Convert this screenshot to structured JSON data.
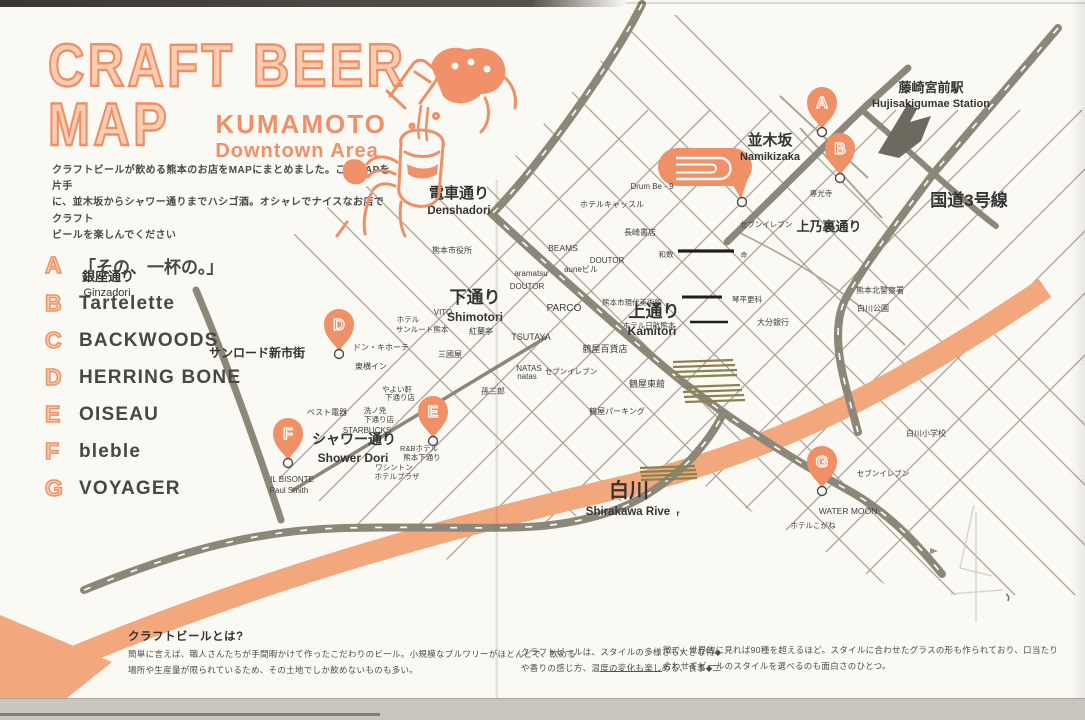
{
  "header": {
    "title_line1": "CRAFT BEER",
    "title_line2": "MAP",
    "subtitle_region": "KUMAMOTO",
    "subtitle_area": "Downtown Area",
    "intro_lines": [
      "クラフトビールが飲める熊本のお店をMAPにまとめました。このMAPを片手",
      "に、並木坂からシャワー通りまでハシゴ酒。オシャレでナイスなお店でクラフト",
      "ビールを楽しんでください"
    ]
  },
  "legend": {
    "items": [
      {
        "letter": "A",
        "name": "「その、一杯の。」"
      },
      {
        "letter": "B",
        "name": "Tartelette"
      },
      {
        "letter": "C",
        "name": "BACKWOODS"
      },
      {
        "letter": "D",
        "name": "HERRING BONE"
      },
      {
        "letter": "E",
        "name": "OISEAU"
      },
      {
        "letter": "F",
        "name": "bleble"
      },
      {
        "letter": "G",
        "name": "VOYAGER"
      }
    ]
  },
  "map": {
    "pins": [
      "A",
      "B",
      "C",
      "D",
      "E",
      "F",
      "G"
    ],
    "streets": {
      "denshadori": {
        "jp": "電車通り",
        "en": "Denshadori"
      },
      "ginzadori": {
        "jp": "銀座通り",
        "en": "Ginzadori"
      },
      "shimotori": {
        "jp": "下通り",
        "en": "Shimotori"
      },
      "kamitori": {
        "jp": "上通り",
        "en": "Kamitori"
      },
      "namikizaka": {
        "jp": "並木坂",
        "en": "Namikizaka"
      },
      "shower": {
        "jp": "シャワー通り",
        "en": "Shower Dori"
      },
      "shirakawa": {
        "jp": "白川",
        "en": "Shirakawa Rive",
        "en2": "r"
      },
      "station": {
        "jp": "藤崎宮前駅",
        "en": "Hujisakigumae Station"
      },
      "kaminoura": {
        "jp": "上乃裏通り"
      },
      "route3": {
        "jp": "国道3号線"
      },
      "sunroad": {
        "jp": "サンロード新市街"
      }
    },
    "pois": [
      "Drum Be - 9",
      "ホテルキャッスル",
      "長崎書店",
      "BEAMS",
      "DOUTOR",
      "auneビル",
      "aramatsu",
      "DOUTOR",
      "熊本市役所",
      "VITO",
      "ホテル",
      "サンルート熊本",
      "紅蘭亭",
      "TSUTAYA",
      "PARCO",
      "三國屋",
      "NATAS",
      "natas",
      "セブンイレブン",
      "鶴屋百貨店",
      "孫三郎",
      "鶴屋東館",
      "鶴屋パーキング",
      "ドン・キホーテ",
      "東横イン",
      "やよい軒",
      "下通り店",
      "洗ノ兇",
      "下通り店",
      "STARBUCKS",
      "ベスト電器",
      "ワシントン",
      "ホテルプラザ",
      "R&Bホテル",
      "熊本下通り",
      "IL BISONTE",
      "Paul Smith",
      "熊本市現代美術館",
      "ホテル日航熊本",
      "琴平更科",
      "大分銀行",
      "和数",
      "命",
      "専光寺",
      "セブンイレブン",
      "セブンイレブン",
      "WATER MOON",
      "ホテルこがね",
      "熊本北警察署",
      "白川公園",
      "白川小学校"
    ]
  },
  "footer": {
    "heading": "クラフトビールとは?",
    "left_lines": [
      "簡単に言えば、職人さんたちが手間暇かけて作ったこだわりのビール。小規模なブルワリーがほとんどで、飲める",
      "場所や生産量が限られているため、その土地でしか飲めないものも多い。"
    ],
    "mid_lines": [
      "クラフトビールは、スタイルの多様さも大きな特◆",
      "や香りの感じ方、温度の変化も楽しめる、食事◆二"
    ],
    "right_lines": [
      "徴で、世界的に見れば90種を超えるほど。スタイルに合わせたグラスの形も作られており、口当たり",
      "合わせてビールのスタイルを選べるのも面白さのひとつ。"
    ]
  },
  "colors": {
    "accent": "#ef8f66",
    "pin": "#f09066",
    "road": "#8d8779",
    "river": "#f3a77c",
    "ink": "#3b3b3b"
  }
}
